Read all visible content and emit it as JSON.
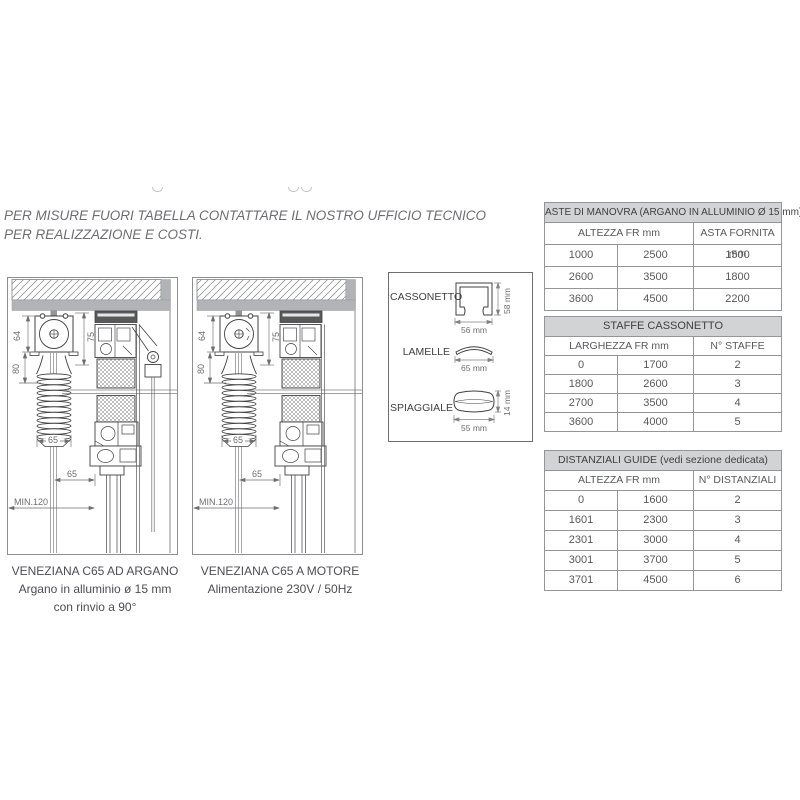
{
  "note": "PER MISURE FUORI TABELLA CONTATTARE IL NOSTRO UFFICIO TECNICO PER REALIZZAZIONE E COSTI.",
  "diagrams": {
    "argano": {
      "dims": {
        "d64": "64",
        "d75": "75",
        "d80": "80",
        "d65a": "65",
        "d65b": "65",
        "min120": "MIN.120"
      },
      "caption_line1": "VENEZIANA C65 AD ARGANO",
      "caption_line2": "Argano in alluminio ø 15 mm",
      "caption_line3": "con rinvio a 90°"
    },
    "motore": {
      "dims": {
        "d64": "64",
        "d75": "75",
        "d80": "80",
        "d65a": "65",
        "d65b": "65",
        "min120": "MIN.120"
      },
      "caption_line1": "VENEZIANA C65 A MOTORE",
      "caption_line2": "Alimentazione 230V / 50Hz"
    }
  },
  "profiles": {
    "cassonetto": {
      "label": "CASSONETTO",
      "width": "56 mm",
      "height": "58 mm"
    },
    "lamelle": {
      "label": "LAMELLE",
      "width": "65 mm"
    },
    "spiaggiale": {
      "label": "SPIAGGIALE",
      "width": "55 mm",
      "height": "14 mm"
    }
  },
  "tables": {
    "aste": {
      "title": "ASTE DI MANOVRA (ARGANO IN ALLUMINIO Ø 15 mm)",
      "col_group": "ALTEZZA FR mm",
      "col_right": "ASTA FORNITA mm",
      "rows": [
        [
          "1000",
          "2500",
          "1500"
        ],
        [
          "2600",
          "3500",
          "1800"
        ],
        [
          "3600",
          "4500",
          "2200"
        ]
      ]
    },
    "staffe": {
      "title": "STAFFE CASSONETTO",
      "col_group": "LARGHEZZA FR mm",
      "col_right": "N° STAFFE",
      "rows": [
        [
          "0",
          "1700",
          "2"
        ],
        [
          "1800",
          "2600",
          "3"
        ],
        [
          "2700",
          "3500",
          "4"
        ],
        [
          "3600",
          "4000",
          "5"
        ]
      ]
    },
    "distanziali": {
      "title": "DISTANZIALI GUIDE (vedi sezione dedicata)",
      "col_group": "ALTEZZA FR mm",
      "col_right": "N° DISTANZIALI",
      "rows": [
        [
          "0",
          "1600",
          "2"
        ],
        [
          "1601",
          "2300",
          "3"
        ],
        [
          "2301",
          "3000",
          "4"
        ],
        [
          "3001",
          "3700",
          "5"
        ],
        [
          "3701",
          "4500",
          "6"
        ]
      ]
    }
  },
  "colors": {
    "table_header_bg": "#d1d3d4",
    "table_border": "#939598",
    "body_text": "#58595b",
    "ceiling_gray": "#b1b3b6"
  }
}
